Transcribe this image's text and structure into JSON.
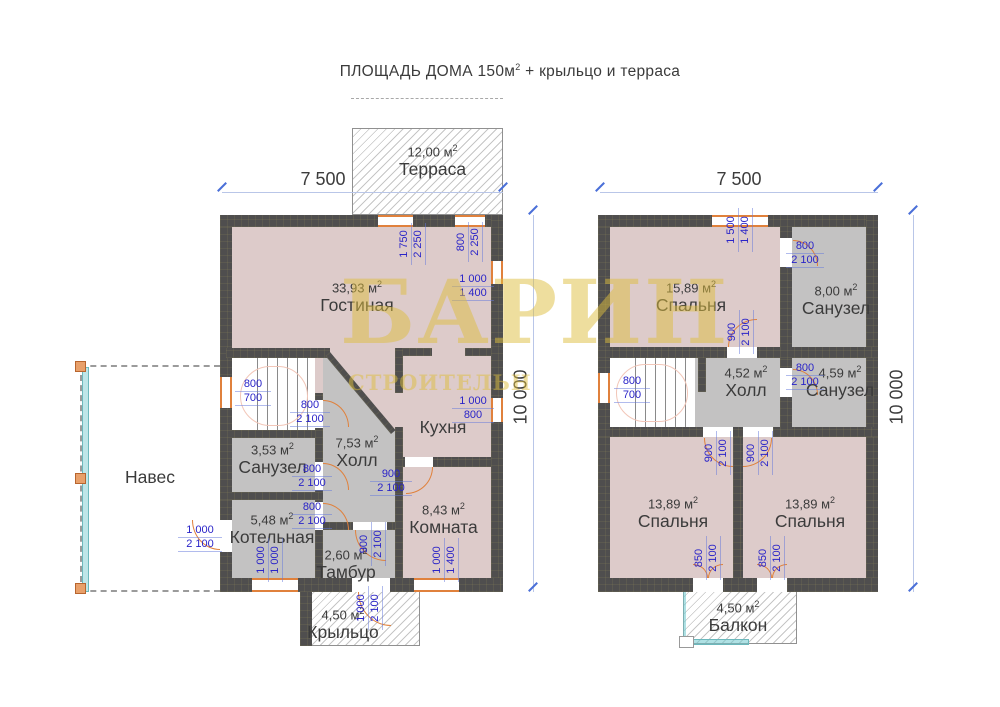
{
  "title": {
    "prefix": "ПЛОЩАДЬ ДОМА 150м",
    "sup": "2",
    "suffix": " + крыльцо и терраса"
  },
  "watermark": {
    "main": "БАРИН",
    "sub": "СТРОИТЕЛЬН"
  },
  "unit": {
    "base": "м",
    "sup": "2"
  },
  "colors": {
    "wall": "#4f4e4e",
    "room_pink": "#ddcbca",
    "room_gray": "#c3c2c2",
    "opening_accent": "#e0813c",
    "dim_blue": "#2a24c8",
    "watermark_yellow": "#e3c54a"
  },
  "floor1": {
    "dim_width": "7 500",
    "dim_height": "10 000",
    "terrace": {
      "area": "12,00",
      "name": "Терраса"
    },
    "porch": {
      "area": "4,50",
      "name": "Крыльцо"
    },
    "canopy": {
      "name": "Навес"
    },
    "living": {
      "area": "33,93",
      "name": "Гостиная"
    },
    "kitchen": {
      "name": "Кухня"
    },
    "hall": {
      "area": "7,53",
      "name": "Холл"
    },
    "bathroom": {
      "area": "3,53",
      "name": "Санузел"
    },
    "boiler": {
      "area": "5,48",
      "name": "Котельная"
    },
    "vestibule": {
      "area": "2,60",
      "name": "Тамбур"
    },
    "room": {
      "area": "8,43",
      "name": "Комната"
    },
    "openings": {
      "terrace_window": {
        "w": "1 750",
        "h": "2 250"
      },
      "terrace_door": {
        "w": "800",
        "h": "2 250"
      },
      "living_window": {
        "w": "1 000",
        "h": "1 400"
      },
      "kitchen_window": {
        "w": "1 000",
        "h": "800"
      },
      "stairs_window": {
        "w": "800",
        "h": "700"
      },
      "stairs_door": {
        "w": "800",
        "h": "2 100"
      },
      "bathroom_door": {
        "w": "800",
        "h": "2 100"
      },
      "room_door": {
        "w": "900",
        "h": "2 100"
      },
      "boiler_door": {
        "w": "800",
        "h": "2 100"
      },
      "canopy_door": {
        "w": "1 000",
        "h": "2 100"
      },
      "boiler_window": {
        "w": "1 000",
        "h": "1 000"
      },
      "vestibule_door": {
        "w": "900",
        "h": "2 100"
      },
      "room_window": {
        "w": "1 000",
        "h": "1 400"
      },
      "porch_door": {
        "w": "1 000",
        "h": "2 100"
      }
    }
  },
  "floor2": {
    "dim_width": "7 500",
    "dim_height": "10 000",
    "bedroom1": {
      "area": "15,89",
      "name": "Спальня"
    },
    "bathroom1": {
      "area": "8,00",
      "name": "Санузел"
    },
    "hall": {
      "area": "4,52",
      "name": "Холл"
    },
    "bathroom2": {
      "area": "4,59",
      "name": "Санузел"
    },
    "bedroom2": {
      "area": "13,89",
      "name": "Спальня"
    },
    "bedroom3": {
      "area": "13,89",
      "name": "Спальня"
    },
    "balcony": {
      "area": "4,50",
      "name": "Балкон"
    },
    "openings": {
      "top_window": {
        "w": "1 500",
        "h": "1 400"
      },
      "bathroom1_door": {
        "w": "800",
        "h": "2 100"
      },
      "bedroom1_door": {
        "w": "900",
        "h": "2 100"
      },
      "stairs_window": {
        "w": "800",
        "h": "700"
      },
      "bathroom2_door": {
        "w": "800",
        "h": "2 100"
      },
      "bedroom2_door": {
        "w": "900",
        "h": "2 100"
      },
      "bedroom3_door": {
        "w": "900",
        "h": "2 100"
      },
      "balcony_door_left": {
        "w": "850",
        "h": "2 100"
      },
      "balcony_door_right": {
        "w": "850",
        "h": "2 100"
      }
    }
  }
}
